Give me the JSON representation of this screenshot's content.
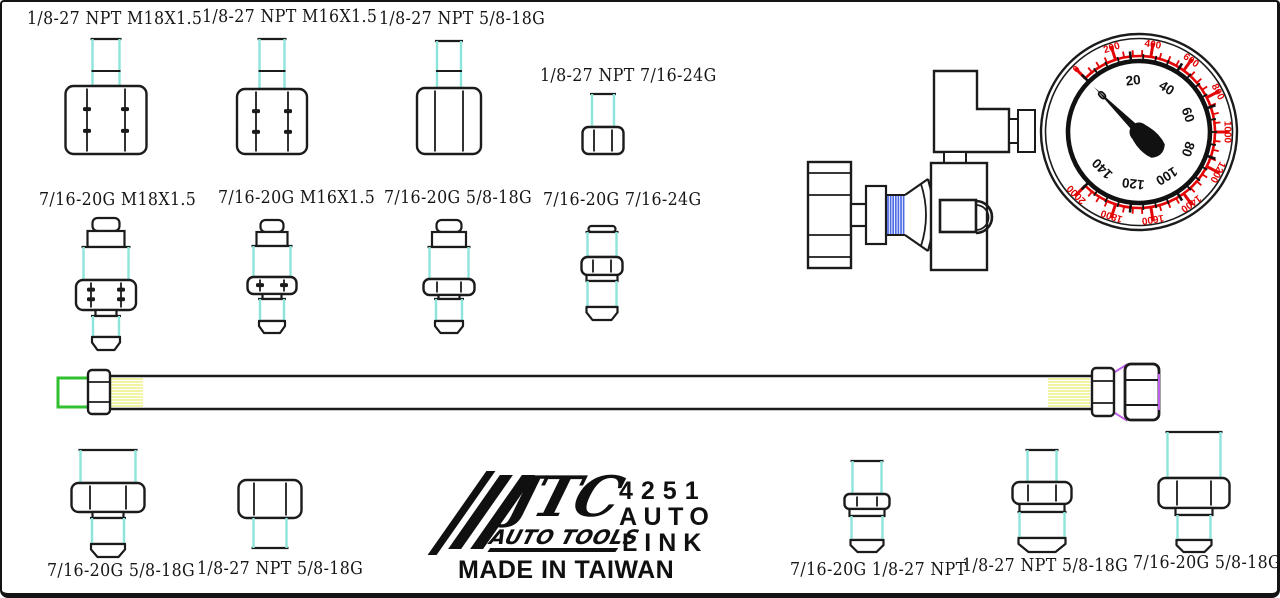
{
  "product": {
    "brand": "JTC",
    "brand_sub": "AUTO TOOLS",
    "model_number": "4251",
    "model_name_line1": "AUTO",
    "model_name_line2": "LINK",
    "origin": "MADE IN TAIWAN"
  },
  "adapters": {
    "row1": [
      {
        "label": "1/8-27 NPT M18X1.5"
      },
      {
        "label": "1/8-27 NPT M16X1.5"
      },
      {
        "label": "1/8-27 NPT 5/8-18G"
      },
      {
        "label": "1/8-27 NPT 7/16-24G"
      }
    ],
    "row2": [
      {
        "label": "7/16-20G M18X1.5"
      },
      {
        "label": "7/16-20G M16X1.5"
      },
      {
        "label": "7/16-20G 5/8-18G"
      },
      {
        "label": "7/16-20G 7/16-24G"
      }
    ],
    "bottom_left": [
      {
        "label": "7/16-20G 5/8-18G"
      },
      {
        "label": "1/8-27 NPT 5/8-18G"
      }
    ],
    "bottom_right": [
      {
        "label": "7/16-20G 1/8-27 NPT"
      },
      {
        "label": "1/8-27 NPT 5/8-18G"
      },
      {
        "label": "7/16-20G 5/8-18G"
      }
    ]
  },
  "gauge": {
    "start_angle_deg": 135,
    "sweep_deg": 270,
    "needle_value": 0,
    "outer_scale": {
      "min": 0,
      "max": 2000,
      "major_step": 200,
      "minor_step": 50,
      "values": [
        0,
        200,
        400,
        600,
        800,
        1000,
        1200,
        1400,
        1600,
        1800,
        2000
      ],
      "color": "#e30505"
    },
    "inner_scale": {
      "min": 0,
      "max": 140,
      "major_step": 20,
      "minor_step": 5,
      "values": [
        0,
        20,
        40,
        60,
        80,
        100,
        120,
        140
      ],
      "color": "#111111"
    }
  },
  "colors": {
    "line": "#1b1b1b",
    "accent_cyan": "#8ce4da",
    "accent_green": "#30c030",
    "accent_yellow": "#efef86",
    "accent_purple": "#be5fe8",
    "accent_blue": "#4d6be6",
    "gauge_red": "#e30505"
  }
}
